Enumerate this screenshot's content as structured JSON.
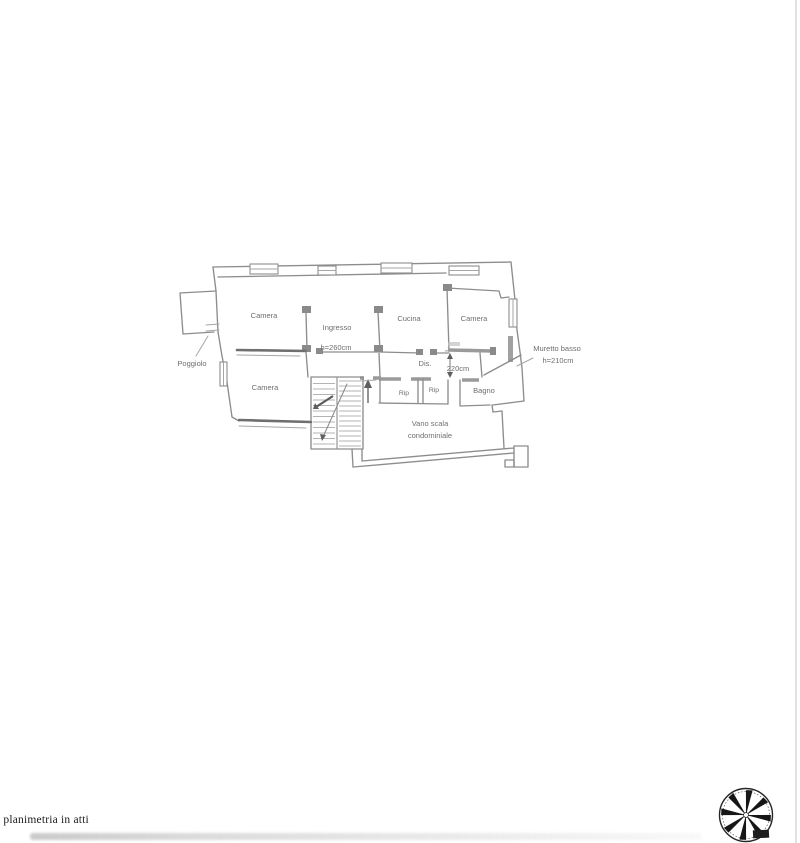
{
  "document": {
    "footer_note": "a planimetria in atti"
  },
  "plan": {
    "labels": [
      {
        "id": "camera-nw",
        "text": "Camera"
      },
      {
        "id": "ingresso",
        "text": "Ingresso"
      },
      {
        "id": "ingresso-height",
        "text": "h=260cm"
      },
      {
        "id": "cucina",
        "text": "Cucina"
      },
      {
        "id": "camera-ne",
        "text": "Camera"
      },
      {
        "id": "camera-sw",
        "text": "Camera"
      },
      {
        "id": "poggiolo",
        "text": "Poggiolo"
      },
      {
        "id": "dis",
        "text": "Dis."
      },
      {
        "id": "dim-220",
        "text": "220cm"
      },
      {
        "id": "rip-1",
        "text": "Rip"
      },
      {
        "id": "rip-2",
        "text": "Rip"
      },
      {
        "id": "bagno",
        "text": "Bagno"
      },
      {
        "id": "vano-scala-1",
        "text": "Vano scala"
      },
      {
        "id": "vano-scala-2",
        "text": "condominiale"
      },
      {
        "id": "muretto-1",
        "text": "Muretto basso"
      },
      {
        "id": "muretto-2",
        "text": "h=210cm"
      }
    ]
  },
  "icons": {
    "compass": "compass-rose-icon"
  },
  "colors": {
    "paper": "#ffffff",
    "sketch_line": "#8d8d8d",
    "label_text": "#6e6e6e",
    "footer_text": "#1b1b1b",
    "compass_ink": "#161616"
  }
}
